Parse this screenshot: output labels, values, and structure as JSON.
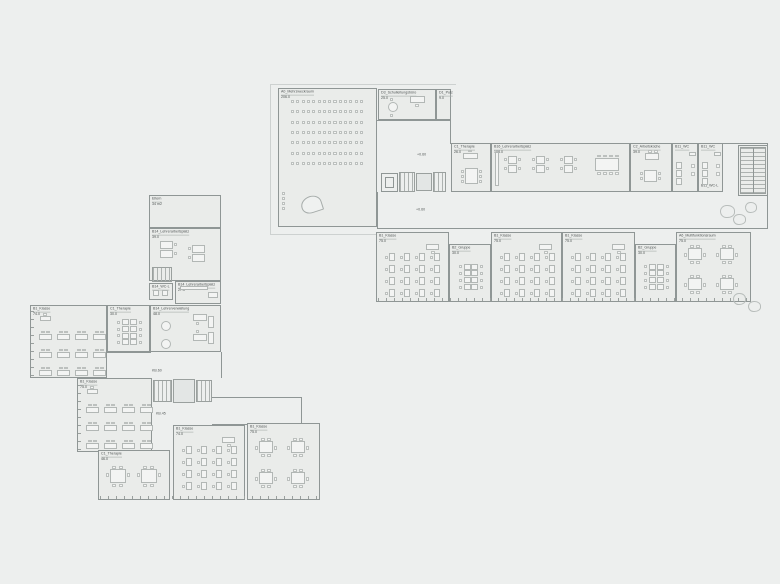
{
  "colors": {
    "background": "#edefee",
    "wall": "#8f9695",
    "room_fill": "#eaecea",
    "furniture": "#b2b7b5",
    "text": "#4f5454"
  },
  "rooms": [
    {
      "id": "mehrzweckraum",
      "label": "A0_Mehrzweckraum",
      "area": "206.0",
      "x": 278,
      "y": 88,
      "w": 99,
      "h": 139,
      "furn": "hall"
    },
    {
      "id": "schulleitungsbuero",
      "label": "D3_Schulleitungsbüro",
      "area": "25.0",
      "x": 378,
      "y": 89,
      "w": 58,
      "h": 31,
      "furn": "admin"
    },
    {
      "id": "putzraum",
      "label": "D1_Putz",
      "area": "9.0",
      "x": 436,
      "y": 89,
      "w": 15,
      "h": 31
    },
    {
      "id": "therapie-ost",
      "label": "C1_Therapie",
      "area": "26.0",
      "x": 451,
      "y": 143,
      "w": 40,
      "h": 49,
      "furn": "therapySmall"
    },
    {
      "id": "lehrerarbeitsplatz-108",
      "label": "B16_Lehrerarbeitsplatz",
      "area": "108.0",
      "x": 491,
      "y": 143,
      "w": 139,
      "h": 49,
      "furn": "teacher108"
    },
    {
      "id": "arbeitskueche",
      "label": "C2_Arbeitsküche",
      "area": "39.0",
      "x": 630,
      "y": 143,
      "w": 42,
      "h": 49,
      "furn": "kitchen"
    },
    {
      "id": "wc-1",
      "label": "B11_WC",
      "area": "",
      "x": 672,
      "y": 143,
      "w": 26,
      "h": 49,
      "furn": "wc"
    },
    {
      "id": "wc-2",
      "label": "B11_WC",
      "area": "",
      "sub": "B11_WC-L",
      "x": 698,
      "y": 143,
      "w": 25,
      "h": 49,
      "furn": "wc"
    },
    {
      "id": "treppenhaus-ost",
      "label": "",
      "area": "",
      "x": 738,
      "y": 145,
      "w": 30,
      "h": 51
    },
    {
      "id": "klasse-o1",
      "label": "B1_Klasse",
      "area": "75.0",
      "x": 376,
      "y": 232,
      "w": 73,
      "h": 70,
      "furn": "classV"
    },
    {
      "id": "gruppe-o1",
      "label": "B2_Gruppe",
      "area": "30.0",
      "x": 449,
      "y": 244,
      "w": 42,
      "h": 58,
      "furn": "longTable"
    },
    {
      "id": "klasse-o2",
      "label": "B1_Klasse",
      "area": "75.0",
      "x": 491,
      "y": 232,
      "w": 71,
      "h": 70,
      "furn": "classV"
    },
    {
      "id": "klasse-o3",
      "label": "B1_Klasse",
      "area": "75.0",
      "x": 562,
      "y": 232,
      "w": 73,
      "h": 70,
      "furn": "classV"
    },
    {
      "id": "gruppe-o2",
      "label": "B2_Gruppe",
      "area": "30.0",
      "x": 635,
      "y": 244,
      "w": 41,
      "h": 58,
      "furn": "longTable"
    },
    {
      "id": "multifunktionsraum",
      "label": "A6_Multifunktionsraum",
      "area": "75.0",
      "x": 676,
      "y": 232,
      "w": 75,
      "h": 70,
      "furn": "groups4"
    },
    {
      "id": "eltern",
      "label": "Eltern",
      "area": "34 m2",
      "x": 149,
      "y": 195,
      "w": 72,
      "h": 33
    },
    {
      "id": "lehrerarbeitsplatz-39",
      "label": "B14_Lehrerarbeitsplatz",
      "area": "39.0",
      "x": 149,
      "y": 228,
      "w": 72,
      "h": 53,
      "furn": "teacher39"
    },
    {
      "id": "wc-l",
      "label": "B14_WC-L",
      "area": "",
      "x": 149,
      "y": 283,
      "w": 24,
      "h": 17,
      "furn": "wcl"
    },
    {
      "id": "lehrerarbeitsplatz-27",
      "label": "B14_Lehrerarbeitsplatz",
      "area": "27.0",
      "x": 175,
      "y": 281,
      "w": 46,
      "h": 23,
      "furn": "lap27"
    },
    {
      "id": "klasse-w1",
      "label": "B1_Klasse",
      "area": "74.0",
      "x": 30,
      "y": 305,
      "w": 77,
      "h": 73,
      "furn": "classH"
    },
    {
      "id": "therapie-30",
      "label": "C1_Therapie",
      "area": "30.0",
      "x": 107,
      "y": 305,
      "w": 43,
      "h": 47,
      "furn": "longTable"
    },
    {
      "id": "lehrerverwaltung",
      "label": "B14_Lehrerverwaltung",
      "area": "48.0",
      "x": 150,
      "y": 305,
      "w": 71,
      "h": 47,
      "furn": "verw"
    },
    {
      "id": "klasse-w2",
      "label": "B1_Klasse",
      "area": "75.0",
      "x": 77,
      "y": 378,
      "w": 75,
      "h": 74,
      "furn": "classH"
    },
    {
      "id": "therapie-46",
      "label": "C1_Therapie",
      "area": "46.0",
      "x": 98,
      "y": 450,
      "w": 72,
      "h": 50,
      "furn": "therapy46"
    },
    {
      "id": "klasse-w3",
      "label": "B1_Klasse",
      "area": "74.0",
      "x": 173,
      "y": 425,
      "w": 72,
      "h": 75,
      "furn": "classV"
    },
    {
      "id": "klasse-w4",
      "label": "B1_Klasse",
      "area": "75.0",
      "x": 247,
      "y": 423,
      "w": 73,
      "h": 77,
      "furn": "groups4"
    }
  ],
  "annotations": [
    {
      "text": "+0.60",
      "x": 417,
      "y": 153
    },
    {
      "text": "+0.60",
      "x": 416,
      "y": 208
    },
    {
      "text": "KB.60",
      "x": 152,
      "y": 369
    },
    {
      "text": "KB.45",
      "x": 156,
      "y": 412
    }
  ],
  "walls": [
    {
      "x": 377,
      "y": 120,
      "w": 74,
      "h": 1
    },
    {
      "x": 450,
      "y": 120,
      "w": 1,
      "h": 24
    },
    {
      "x": 450,
      "y": 143,
      "w": 318,
      "h": 1
    },
    {
      "x": 767,
      "y": 143,
      "w": 1,
      "h": 86
    },
    {
      "x": 377,
      "y": 228,
      "w": 391,
      "h": 1
    },
    {
      "x": 377,
      "y": 192,
      "w": 1,
      "h": 36
    },
    {
      "x": 221,
      "y": 352,
      "w": 1,
      "h": 26
    },
    {
      "x": 212,
      "y": 397,
      "w": 90,
      "h": 1
    },
    {
      "x": 212,
      "y": 424,
      "w": 36,
      "h": 1
    },
    {
      "x": 301,
      "y": 397,
      "w": 1,
      "h": 27
    },
    {
      "x": 107,
      "y": 352,
      "w": 44,
      "h": 1
    }
  ],
  "outlines": [
    {
      "x": 270,
      "y": 84,
      "w": 186,
      "h": 1
    },
    {
      "x": 270,
      "y": 84,
      "w": 1,
      "h": 151
    },
    {
      "x": 270,
      "y": 234,
      "w": 173,
      "h": 1
    }
  ],
  "ticks": [
    {
      "x": 378,
      "y": 298,
      "w": 371,
      "h": 3,
      "dir": "h"
    },
    {
      "x": 100,
      "y": 496,
      "w": 219,
      "h": 3,
      "dir": "h"
    },
    {
      "x": 31,
      "y": 307,
      "w": 3,
      "h": 69,
      "dir": "v"
    },
    {
      "x": 78,
      "y": 380,
      "w": 3,
      "h": 70,
      "dir": "v"
    }
  ],
  "stairs": [
    {
      "x": 399,
      "y": 172,
      "w": 16,
      "h": 20,
      "dir": "v"
    },
    {
      "x": 433,
      "y": 172,
      "w": 13,
      "h": 20,
      "dir": "v"
    },
    {
      "x": 740,
      "y": 147,
      "w": 26,
      "h": 47,
      "dir": "h",
      "rail": true
    },
    {
      "x": 153,
      "y": 380,
      "w": 19,
      "h": 22,
      "dir": "v"
    },
    {
      "x": 196,
      "y": 380,
      "w": 16,
      "h": 22,
      "dir": "v"
    },
    {
      "x": 152,
      "y": 267,
      "w": 20,
      "h": 15,
      "dir": "v"
    }
  ],
  "landings": [
    {
      "x": 416,
      "y": 173,
      "w": 16,
      "h": 18
    },
    {
      "x": 173,
      "y": 379,
      "w": 22,
      "h": 24
    }
  ],
  "elevators": [
    {
      "x": 381,
      "y": 173,
      "w": 17,
      "h": 19
    }
  ],
  "trees": [
    {
      "x": 720,
      "y": 205,
      "w": 15,
      "h": 13
    },
    {
      "x": 733,
      "y": 214,
      "w": 13,
      "h": 11
    },
    {
      "x": 745,
      "y": 202,
      "w": 12,
      "h": 11
    },
    {
      "x": 733,
      "y": 293,
      "w": 13,
      "h": 12
    },
    {
      "x": 748,
      "y": 301,
      "w": 13,
      "h": 11
    }
  ],
  "piano": {
    "x": 301,
    "y": 196,
    "w": 21,
    "h": 17
  }
}
